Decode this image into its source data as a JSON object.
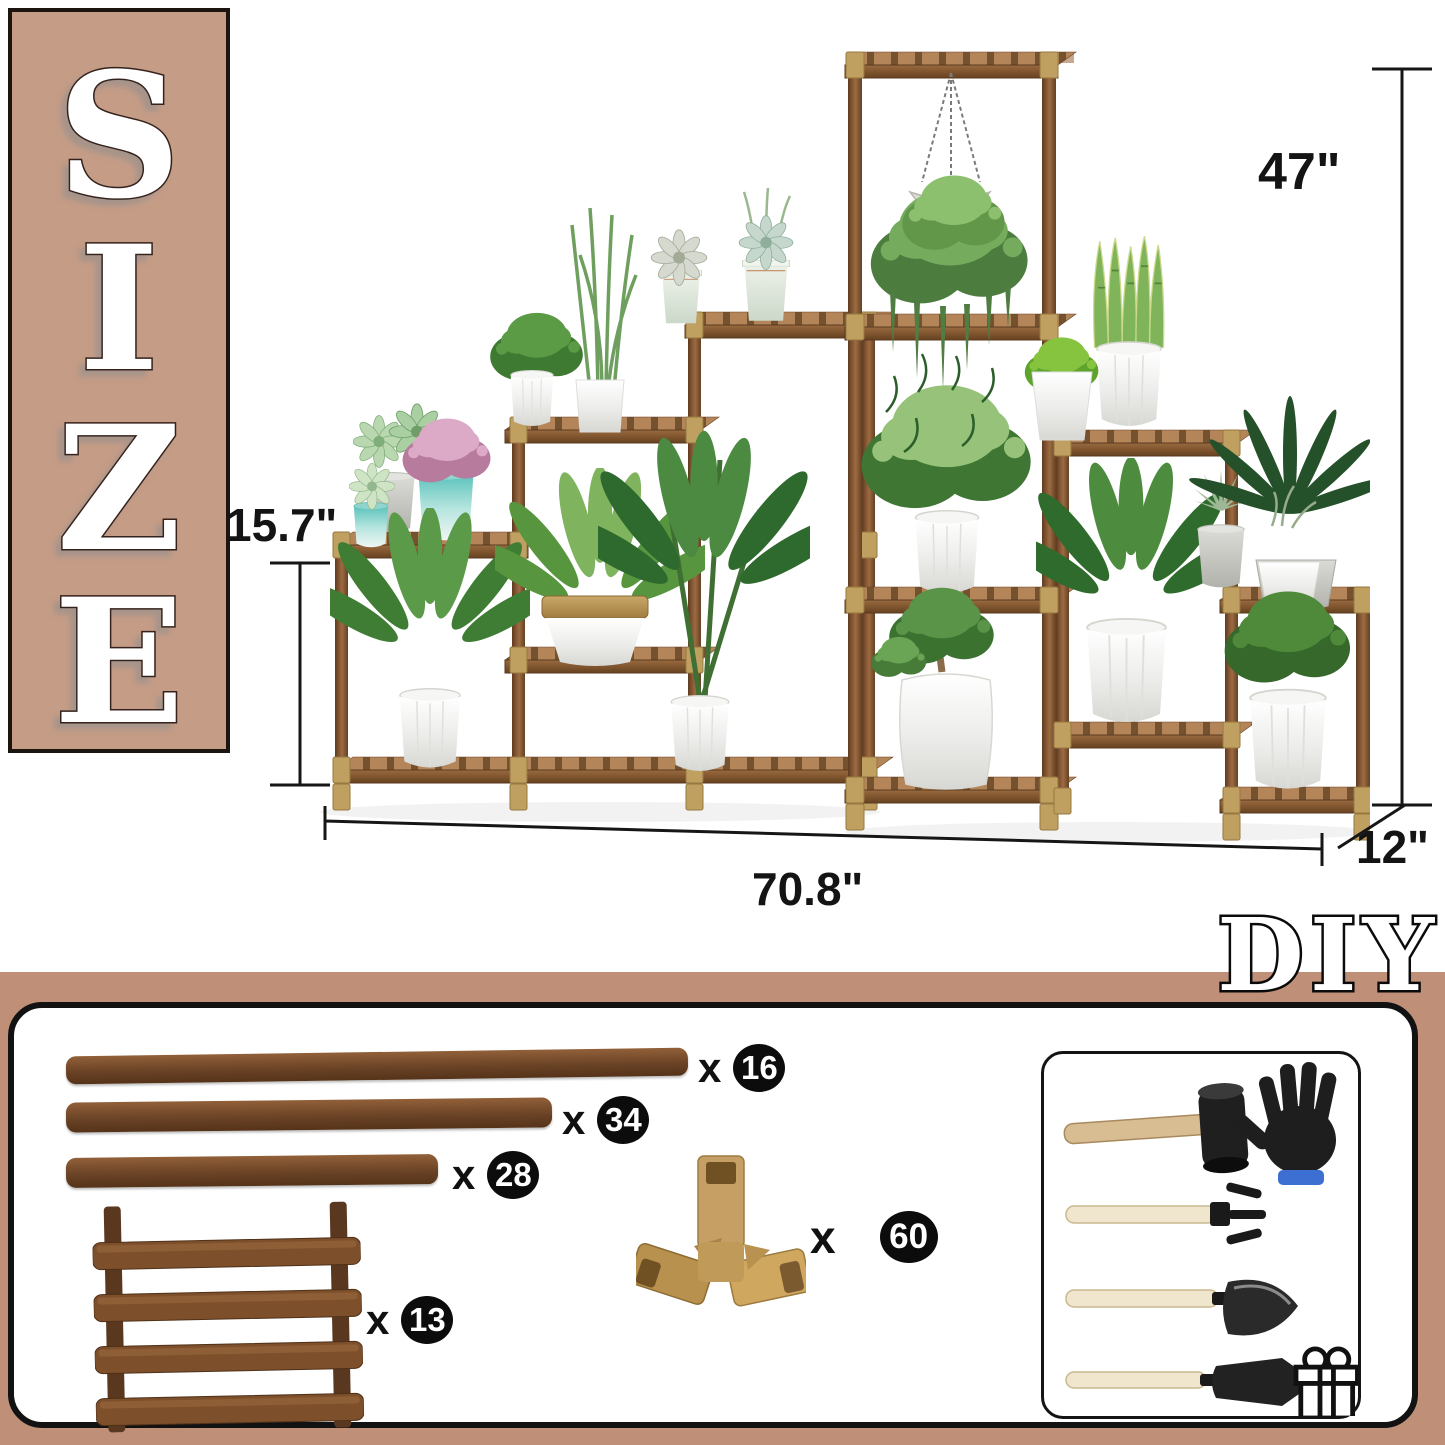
{
  "size_banner": {
    "letters": [
      "S",
      "I",
      "Z",
      "E"
    ]
  },
  "diy_label": "DIY",
  "dimensions": {
    "height": "47\"",
    "tier_height": "15.7\"",
    "width": "70.8\"",
    "depth": "12\""
  },
  "parts": {
    "multiplier": "x",
    "items": [
      {
        "name": "long wood stick",
        "qty": "16"
      },
      {
        "name": "medium wood stick",
        "qty": "34"
      },
      {
        "name": "short wood stick",
        "qty": "28"
      },
      {
        "name": "slatted shelf panel",
        "qty": "13"
      },
      {
        "name": "3-way corner connector",
        "qty": "60"
      }
    ]
  },
  "tools": {
    "items": [
      "rubber mallet",
      "work glove",
      "hand rake",
      "hand shovel",
      "hand trowel"
    ],
    "gift": "gift box"
  },
  "colors": {
    "accent_tan": "#c59c86",
    "band_tan": "#bf8f78",
    "wood_dark": "#6b4326",
    "wood_mid": "#8a5a35",
    "connector_khaki": "#bfa061",
    "badge_black": "#0c0c0c"
  }
}
